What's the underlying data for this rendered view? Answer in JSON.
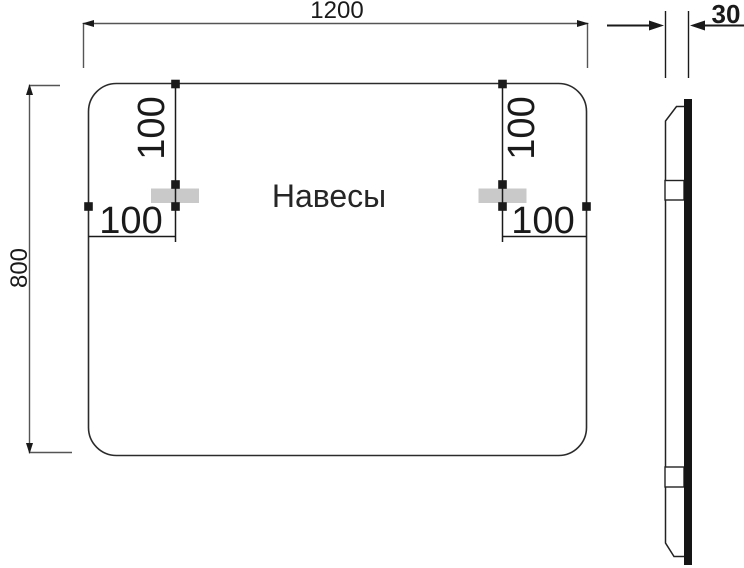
{
  "drawing": {
    "title_label": "Навесы",
    "front_view": {
      "dim_width": "1200",
      "dim_height": "800",
      "hanger_left": {
        "dim_from_top": "100",
        "dim_from_side": "100"
      },
      "hanger_right": {
        "dim_from_top": "100",
        "dim_from_side": "100"
      }
    },
    "side_view": {
      "dim_thickness": "30"
    },
    "colors": {
      "outline": "#2b2b2b",
      "dim_line": "#555555",
      "marker_line": "#1a1a1a",
      "hanger_fill": "#c9c9c9",
      "panel_face": "#151515",
      "text": "#1a1a1a",
      "background": "#ffffff"
    }
  }
}
